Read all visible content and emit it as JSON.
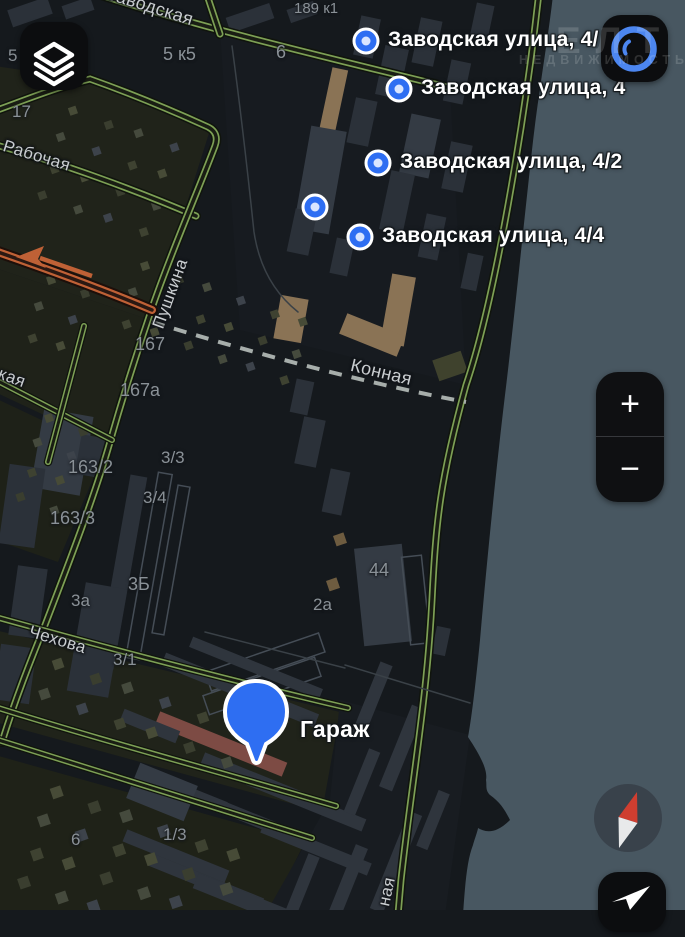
{
  "pins": {
    "items": [
      {
        "label": "Заводская улица, 4/"
      },
      {
        "label": "Заводская улица, 4"
      },
      {
        "label": "Заводская улица, 4/2"
      },
      {
        "label": ""
      },
      {
        "label": "Заводская улица, 4/4"
      }
    ],
    "garage": {
      "label": "Гараж"
    }
  },
  "streets": {
    "zavodskaya": "Заводская",
    "rabochaya": "Рабочая",
    "pushkina": "Пушкина",
    "konnaya": "Конная",
    "chekhova": "Чехова",
    "fragment_kaya": "кая",
    "fragment_naya": "ная"
  },
  "house_numbers": {
    "n5": "5",
    "n17": "17",
    "n5k5": "5 к5",
    "n6top": "6",
    "n189k1": "189 к1",
    "n167": "167",
    "n167a": "167а",
    "n163_2": "163/2",
    "n163_3": "163/3",
    "n3_3": "3/3",
    "n3_4": "3/4",
    "n3b": "3Б",
    "n3a": "3а",
    "n3_1": "3/1",
    "n44": "44",
    "n2a": "2а",
    "n6bottom": "6",
    "n1_3": "1/3"
  },
  "controls": {
    "zoom_in": "+",
    "zoom_out": "−"
  },
  "watermark": {
    "line1": "ЕЛТ",
    "line2": "НЕДВИЖИМОСТЬ"
  },
  "colors": {
    "pin_blue": "#2e6ef2",
    "road_green": "#7da055",
    "water": "#485761",
    "building_tan": "#8a7355",
    "building_red": "#7d4b44",
    "accent_ring": "#4c86f0",
    "compass_red": "#cf3e30"
  }
}
